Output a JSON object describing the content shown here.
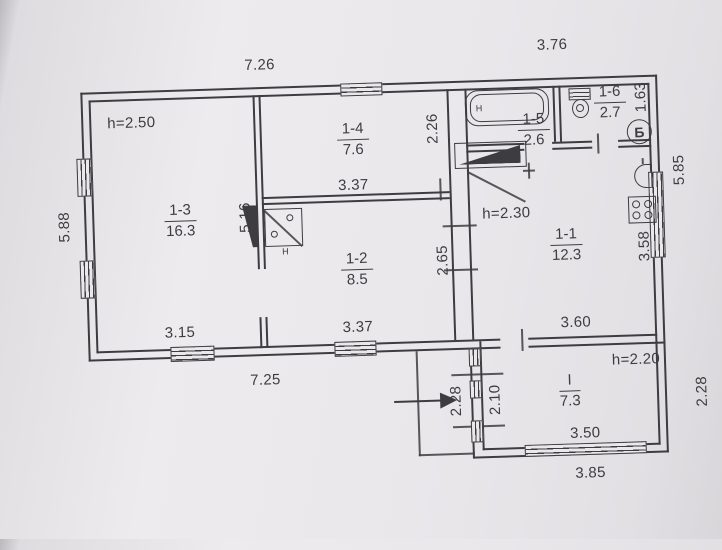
{
  "plan": {
    "heights": {
      "room_1_3": "h=2.50",
      "room_1_1": "h=2.30",
      "annex": "h=2.20"
    },
    "rooms": {
      "r13": {
        "id": "1-3",
        "area": "16.3"
      },
      "r14": {
        "id": "1-4",
        "area": "7.6"
      },
      "r12": {
        "id": "1-2",
        "area": "8.5"
      },
      "r15": {
        "id": "1-5",
        "area": "2.6"
      },
      "r16": {
        "id": "1-6",
        "area": "2.7"
      },
      "r11": {
        "id": "1-1",
        "area": "12.3"
      },
      "annex": {
        "id": "I",
        "area": "7.3"
      }
    },
    "dims": {
      "top_main": "7.26",
      "top_right": "3.76",
      "left": "5.88",
      "right": "5.85",
      "bottom_main": "7.25",
      "bottom_annex": "3.85",
      "annex_inner_width": "3.50",
      "annex_right": "2.28",
      "annex_left": "2.28",
      "annex_inner_left": "2.10",
      "r13_width": "3.15",
      "r12_width": "3.37",
      "r12_top_width": "3.37",
      "r11_width": "3.60",
      "r11_right": "3.58",
      "r12_right": "2.65",
      "r14_right": "2.26",
      "r13_right": "5.16",
      "r16_right": "1.63"
    },
    "marks": {
      "cellar_letter": "Б",
      "tub_tap": "H",
      "stove_tap": "H"
    },
    "colors": {
      "ink": "#3d3c40",
      "paper": "#eae8ea"
    }
  }
}
